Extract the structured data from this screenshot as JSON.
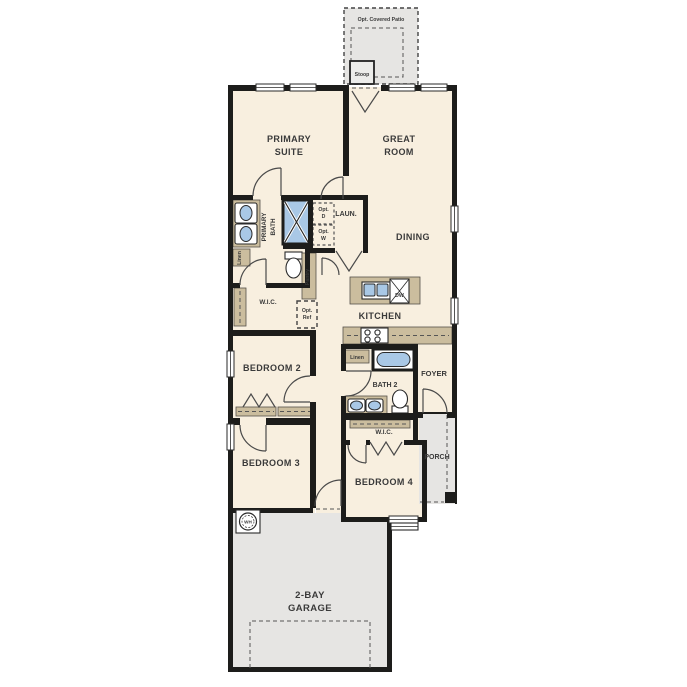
{
  "colors": {
    "wall": "#1d1d1b",
    "room_fill": "#f8efdf",
    "exterior_gray": "#e6e5e3",
    "cabinet_tan": "#cbbd9e",
    "fixture_blue": "#a9c8e6",
    "label_text": "#3a3a3a",
    "background": "#ffffff"
  },
  "plan": {
    "patio": "Opt. Covered Patio",
    "stoop": "Stoop",
    "primary_suite_l1": "PRIMARY",
    "primary_suite_l2": "SUITE",
    "great_room_l1": "GREAT",
    "great_room_l2": "ROOM",
    "primary_bath_l1": "PRIMARY",
    "primary_bath_l2": "BATH",
    "laundry": "LAUN.",
    "opt_d_l1": "Opt.",
    "opt_d_l2": "D",
    "opt_w_l1": "Opt.",
    "opt_w_l2": "W",
    "linen_primary": "Linen",
    "pantry": "Pantry",
    "dining": "DINING",
    "wic_primary": "W.I.C.",
    "opt_ref_l1": "Opt.",
    "opt_ref_l2": "Ref",
    "kitchen": "KITCHEN",
    "dishwasher": "DW",
    "bedroom2": "BEDROOM 2",
    "linen_hall": "Linen",
    "bath2": "BATH 2",
    "foyer": "FOYER",
    "wic_bedroom4": "W.I.C.",
    "porch": "PORCH",
    "bedroom3": "BEDROOM 3",
    "bedroom4": "BEDROOM 4",
    "water_heater": "WH",
    "garage_l1": "2-BAY",
    "garage_l2": "GARAGE"
  }
}
